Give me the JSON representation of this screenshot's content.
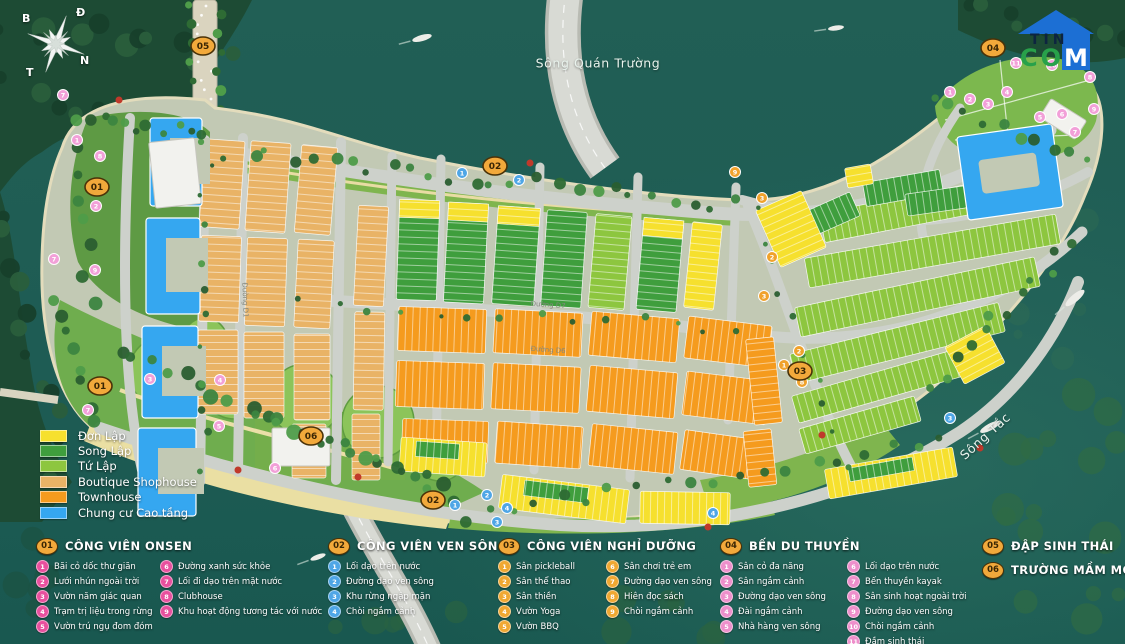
{
  "map": {
    "water_labels": [
      {
        "text": "Sông Quán Trường",
        "x": 598,
        "y": 63,
        "rot": 0
      },
      {
        "text": "Sông Tắc",
        "x": 985,
        "y": 436,
        "rot": -42
      }
    ],
    "compass": {
      "letters": [
        {
          "t": "B",
          "x": 8,
          "y": 8
        },
        {
          "t": "Đ",
          "x": 62,
          "y": 2
        },
        {
          "t": "T",
          "x": 12,
          "y": 62
        },
        {
          "t": "N",
          "x": 66,
          "y": 50
        }
      ]
    },
    "road_labels": [
      {
        "t": "Đường D7",
        "x": 548,
        "y": 307,
        "r": 4
      },
      {
        "t": "Đường D6",
        "x": 548,
        "y": 352,
        "r": 4
      },
      {
        "t": "Đường D1",
        "x": 243,
        "y": 300,
        "r": 88
      }
    ],
    "badges": [
      {
        "label": "05",
        "x": 203,
        "y": 46
      },
      {
        "label": "01",
        "x": 97,
        "y": 187
      },
      {
        "label": "01",
        "x": 100,
        "y": 386
      },
      {
        "label": "02",
        "x": 495,
        "y": 166
      },
      {
        "label": "02",
        "x": 433,
        "y": 500
      },
      {
        "label": "03",
        "x": 800,
        "y": 371
      },
      {
        "label": "04",
        "x": 993,
        "y": 48
      },
      {
        "label": "06",
        "x": 311,
        "y": 436
      }
    ],
    "dot_colors": {
      "pink": "#F2A0D8",
      "blue": "#4FA6E6",
      "orange": "#F0A22C"
    },
    "dots": {
      "pink": [
        [
          63,
          95,
          "7"
        ],
        [
          77,
          140,
          "1"
        ],
        [
          100,
          156,
          "8"
        ],
        [
          96,
          206,
          "2"
        ],
        [
          54,
          259,
          "7"
        ],
        [
          95,
          270,
          "9"
        ],
        [
          150,
          379,
          "3"
        ],
        [
          220,
          380,
          "4"
        ],
        [
          219,
          426,
          "5"
        ],
        [
          88,
          410,
          "7"
        ],
        [
          275,
          468,
          "6"
        ],
        [
          950,
          92,
          "1"
        ],
        [
          970,
          99,
          "2"
        ],
        [
          988,
          104,
          "3"
        ],
        [
          1007,
          92,
          "4"
        ],
        [
          1040,
          117,
          "5"
        ],
        [
          1062,
          114,
          "6"
        ],
        [
          1075,
          132,
          "7"
        ],
        [
          1090,
          77,
          "8"
        ],
        [
          1094,
          109,
          "9"
        ],
        [
          1052,
          65,
          "10"
        ],
        [
          1016,
          63,
          "11"
        ]
      ],
      "blue": [
        [
          462,
          173,
          "1"
        ],
        [
          519,
          180,
          "2"
        ],
        [
          455,
          505,
          "1"
        ],
        [
          487,
          495,
          "2"
        ],
        [
          497,
          522,
          "3"
        ],
        [
          507,
          508,
          "4"
        ],
        [
          713,
          513,
          "4"
        ],
        [
          950,
          418,
          "3"
        ]
      ],
      "orange": [
        [
          735,
          172,
          "9"
        ],
        [
          762,
          198,
          "3"
        ],
        [
          772,
          257,
          "2"
        ],
        [
          764,
          296,
          "3"
        ],
        [
          784,
          365,
          "1"
        ],
        [
          799,
          351,
          "2"
        ],
        [
          802,
          382,
          "8"
        ]
      ]
    }
  },
  "logo": {
    "tin": "TIN",
    "com": "COM"
  },
  "legend": {
    "items": [
      {
        "label": "Đơn Lập",
        "color": "#F6E02E"
      },
      {
        "label": "Song Lập",
        "color": "#3F9E3D"
      },
      {
        "label": "Tứ Lập",
        "color": "#8DC63F"
      },
      {
        "label": "Boutique Shophouse",
        "color": "#E9B366"
      },
      {
        "label": "Townhouse",
        "color": "#F59B1E"
      },
      {
        "label": "Chung cư Cao tầng",
        "color": "#35A7F0"
      }
    ]
  },
  "amenities": {
    "groups": [
      {
        "id": "01",
        "title": "CÔNG VIÊN ONSEN",
        "dot": "#E8509E",
        "x": 36,
        "y": 538,
        "c1": 118,
        "columns": [
          [
            {
              "n": "1",
              "t": "Bãi cỏ dốc thư giãn"
            },
            {
              "n": "2",
              "t": "Lưới nhún ngoài trời"
            },
            {
              "n": "3",
              "t": "Vườn năm giác quan"
            },
            {
              "n": "4",
              "t": "Trạm trị liệu trong rừng"
            },
            {
              "n": "5",
              "t": "Vườn trú ngụ đom đóm"
            }
          ],
          [
            {
              "n": "6",
              "t": "Đường xanh sức khỏe"
            },
            {
              "n": "7",
              "t": "Lối đi dạo trên mặt nước"
            },
            {
              "n": "8",
              "t": "Clubhouse"
            },
            {
              "n": "9",
              "t": "Khu hoạt động tương tác với nước"
            }
          ]
        ]
      },
      {
        "id": "02",
        "title": "CÔNG VIÊN VEN SÔNG",
        "dot": "#4FA6E6",
        "x": 328,
        "y": 538,
        "c1": 0,
        "columns": [
          [
            {
              "n": "1",
              "t": "Lối dạo trên nước"
            },
            {
              "n": "2",
              "t": "Đường dạo ven sông"
            },
            {
              "n": "3",
              "t": "Khu rừng ngập mặn"
            },
            {
              "n": "4",
              "t": "Chòi ngắm cảnh"
            }
          ]
        ]
      },
      {
        "id": "03",
        "title": "CÔNG VIÊN NGHỈ DƯỠNG",
        "dot": "#F0A832",
        "x": 498,
        "y": 538,
        "c1": 102,
        "columns": [
          [
            {
              "n": "1",
              "t": "Sân pickleball"
            },
            {
              "n": "2",
              "t": "Sân thể thao"
            },
            {
              "n": "3",
              "t": "Sân thiền"
            },
            {
              "n": "4",
              "t": "Vườn Yoga"
            },
            {
              "n": "5",
              "t": "Vườn BBQ"
            }
          ],
          [
            {
              "n": "6",
              "t": "Sân chơi trẻ em"
            },
            {
              "n": "7",
              "t": "Đường dạo ven sông"
            },
            {
              "n": "8",
              "t": "Hiên đọc sách"
            },
            {
              "n": "9",
              "t": "Chòi ngắm cảnh"
            }
          ]
        ]
      },
      {
        "id": "04",
        "title": "BẾN DU THUYỀN",
        "dot": "#EE8FCB",
        "x": 720,
        "y": 538,
        "c1": 121,
        "columns": [
          [
            {
              "n": "1",
              "t": "Sân cỏ đa năng"
            },
            {
              "n": "2",
              "t": "Sân ngắm cảnh"
            },
            {
              "n": "3",
              "t": "Đường dạo ven sông"
            },
            {
              "n": "4",
              "t": "Đài ngắm cảnh"
            },
            {
              "n": "5",
              "t": "Nhà hàng ven sông"
            }
          ],
          [
            {
              "n": "6",
              "t": "Lối dạo trên nước"
            },
            {
              "n": "7",
              "t": "Bến thuyền kayak"
            },
            {
              "n": "8",
              "t": "Sân sinh hoạt ngoài trời"
            },
            {
              "n": "9",
              "t": "Đường dạo ven sông"
            },
            {
              "n": "10",
              "t": "Chòi ngắm cảnh"
            },
            {
              "n": "11",
              "t": "Đầm sinh thái"
            }
          ]
        ]
      },
      {
        "id": "05",
        "title": "ĐẬP SINH THÁI",
        "dot": "#F0A832",
        "x": 982,
        "y": 538,
        "c1": 0,
        "columns": []
      },
      {
        "id": "06",
        "title": "TRƯỜNG MẦM MON",
        "dot": "#F0A832",
        "x": 982,
        "y": 562,
        "c1": 0,
        "columns": []
      }
    ]
  }
}
